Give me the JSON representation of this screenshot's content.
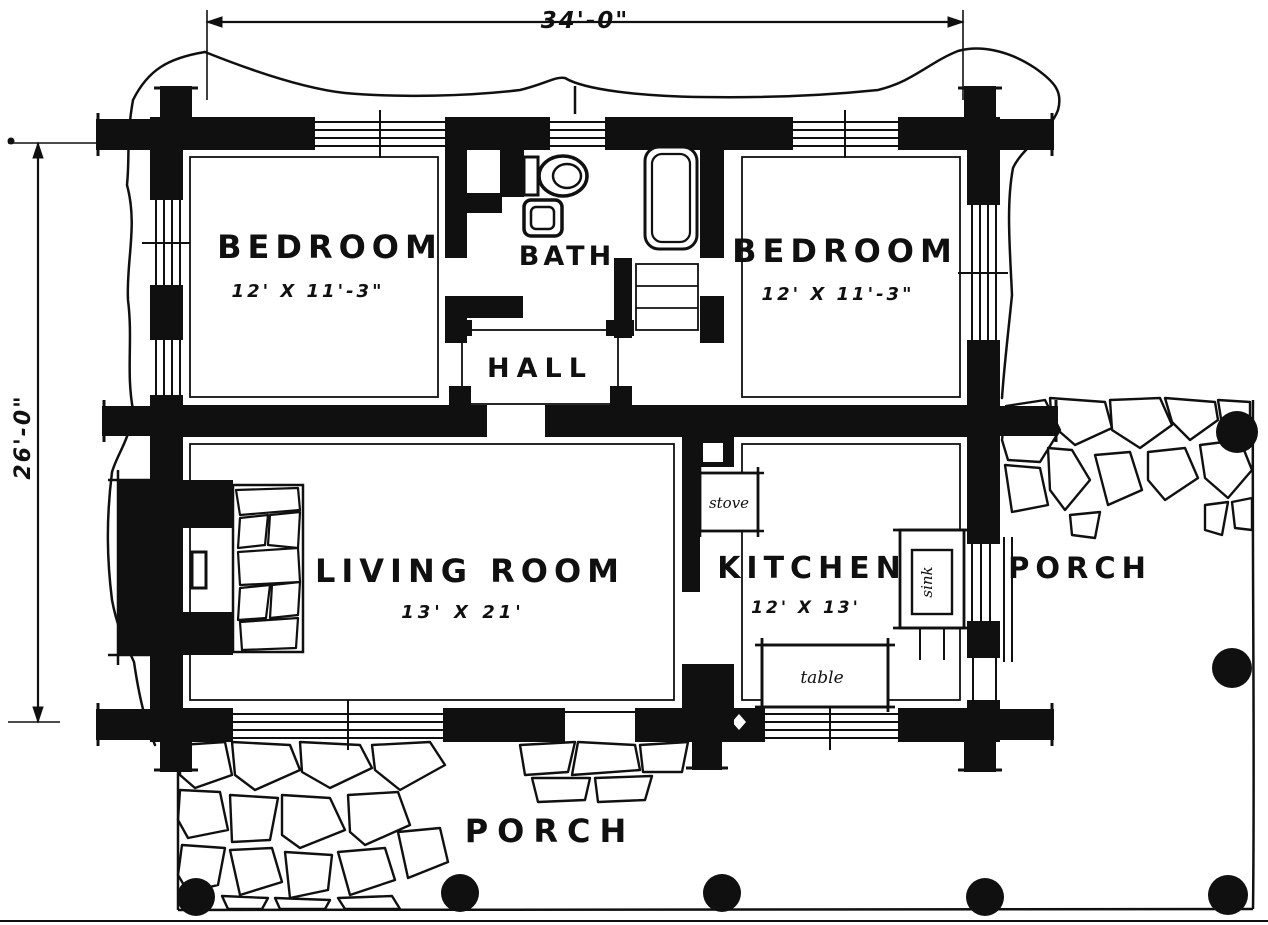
{
  "drawing": {
    "type": "log-cabin floor plan",
    "overall_dimensions": {
      "width_label": "34'-0\"",
      "height_label": "26'-0\""
    },
    "rooms": {
      "bedroom_left": {
        "name": "BEDROOM",
        "size": "12' X 11'-3\""
      },
      "bedroom_right": {
        "name": "BEDROOM",
        "size": "12' X 11'-3\""
      },
      "bath": {
        "name": "BATH"
      },
      "hall": {
        "name": "HALL"
      },
      "living_room": {
        "name": "LIVING ROOM",
        "size": "13' X 21'"
      },
      "kitchen": {
        "name": "KITCHEN",
        "size": "12' X 13'"
      },
      "porch_side": {
        "name": "PORCH"
      },
      "porch_front": {
        "name": "PORCH"
      }
    },
    "fixtures": {
      "stove": "stove",
      "sink": "sink",
      "table": "table"
    },
    "colors": {
      "ink": "#101010",
      "paper": "#ffffff"
    }
  }
}
